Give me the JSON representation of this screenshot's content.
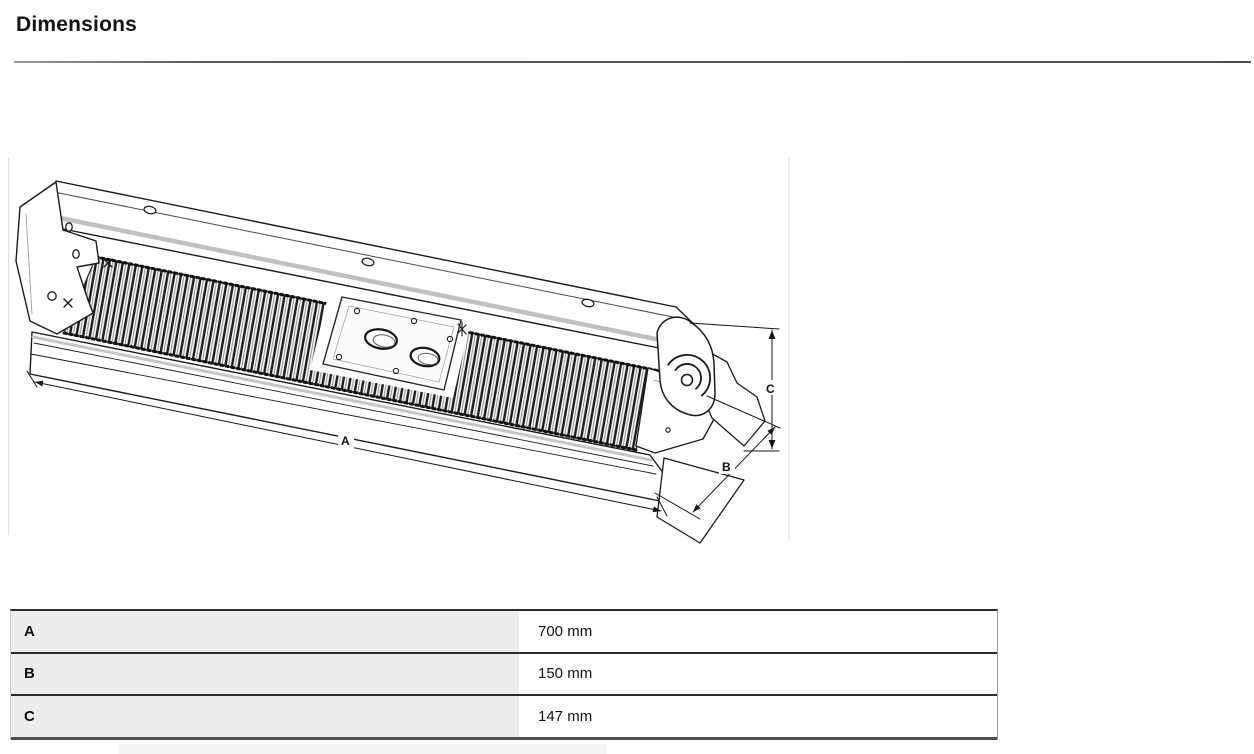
{
  "header": {
    "title": "Dimensions"
  },
  "drawing": {
    "alt": "isometric-line-drawing-of-linear-finned-heater",
    "dim_a": {
      "label": "A"
    },
    "dim_b": {
      "label": "B"
    },
    "dim_c": {
      "label": "C"
    }
  },
  "dimensions_table": {
    "rows": [
      {
        "label": "A",
        "value": "700 mm"
      },
      {
        "label": "B",
        "value": "150 mm"
      },
      {
        "label": "C",
        "value": "147 mm"
      }
    ]
  }
}
